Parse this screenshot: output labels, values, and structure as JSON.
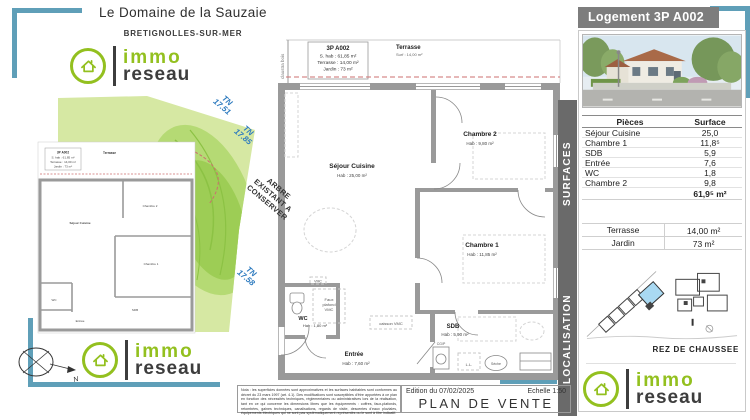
{
  "header": {
    "title": "Le Domaine de la Sauzaie",
    "subtitle": "BRETIGNOLLES-SUR-MER"
  },
  "logo": {
    "immo": "immo",
    "reseau": "reseau"
  },
  "colors": {
    "accent_teal": "#5f9fb8",
    "brand_green": "#93c01f",
    "banner_gray": "#7d7d7d",
    "wall_gray": "#9a9a9a",
    "garden_green": "#d6e8a3",
    "highlight_blue": "#a9d9f2",
    "tn_blue": "#2e7bbf",
    "red_dashed": "#cc6f6f"
  },
  "info_box": {
    "title": "3P A002",
    "hab": "S. hab : 61,85 m²",
    "terrasse": "Terrasse : 14,00 m²",
    "jardin": "Jardin : 73 m²"
  },
  "plan": {
    "claustra": "claustra bois",
    "terrasse_name": "Terrasse",
    "terrasse_surface": "Surf : 14,00 m²",
    "rooms": [
      {
        "name": "Séjour Cuisine",
        "area": "Hab : 25,00 m²"
      },
      {
        "name": "Chambre 2",
        "area": "Hab : 9,80 m²"
      },
      {
        "name": "Chambre 1",
        "area": "Hab : 11,85 m²"
      },
      {
        "name": "WC",
        "area": "Hab : 1,80 m²"
      },
      {
        "name": "Entrée",
        "area": "Hab : 7,60 m²"
      },
      {
        "name": "SDB",
        "area": "Hab : 5,90 m²"
      }
    ],
    "notes": {
      "vmc": "VMC",
      "faux1": "Faux",
      "faux2": "plafond",
      "faux3": "VMC",
      "caisson": "caisson VMC",
      "ll": "L.L.",
      "seche": "Sèche",
      "cgp": "CG/P"
    },
    "tree_note": {
      "l1": "ARBRE",
      "l2": "EXISTANT A",
      "l3": "CONSERVER"
    },
    "tn": [
      {
        "a": "TN",
        "b": "17.51"
      },
      {
        "a": "TN",
        "b": "17.85"
      },
      {
        "a": "TN",
        "b": "17.58"
      }
    ],
    "compass_n": "N"
  },
  "side": {
    "banner": "Logement 3P A002",
    "surfaces_tab": "SURFACES",
    "localisation_tab": "LOCALISATION",
    "table": {
      "col_piece": "Pièces",
      "col_surface": "Surface",
      "rows": [
        {
          "piece": "Séjour Cuisine",
          "surface": "25,0"
        },
        {
          "piece": "Chambre 1",
          "surface": "11,8⁵"
        },
        {
          "piece": "SDB",
          "surface": "5,9"
        },
        {
          "piece": "Entrée",
          "surface": "7,6"
        },
        {
          "piece": "WC",
          "surface": "1,8"
        },
        {
          "piece": "Chambre 2",
          "surface": "9,8"
        }
      ],
      "total": "61,9⁵ m²"
    },
    "exterior": {
      "rows": [
        {
          "label": "Terrasse",
          "value": "14,00 m²"
        },
        {
          "label": "Jardin",
          "value": "73 m²"
        }
      ]
    },
    "floor": "REZ DE CHAUSSEE"
  },
  "footer": {
    "nota": "Nota : les superficies données sont approximatives et les surfaces habitables sont conformes au décret du 23 mars 1997 (art. 4.1). Des modifications sont susceptibles d'être apportées à ce plan en fonction des nécessités techniques, réglementaires ou administratives lors de la réalisation, tant en ce qui concerne les dimensions libres que les équipements : coffres, faux-plafonds, retombées, gaines techniques, canalisations, regards de visite, descentes d'eaux pluviales, équipements électriques qui ne sont pas systématiquement représentés ou le sont à titre indicatif.",
    "edition": "Edition du 07/02/2025",
    "scale": "Echelle 1:50",
    "title": "PLAN DE VENTE"
  }
}
